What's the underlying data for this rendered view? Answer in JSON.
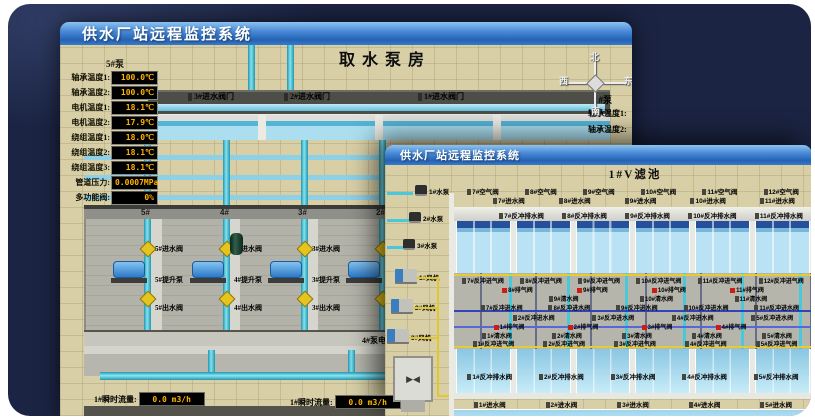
{
  "colors": {
    "shell_bg": "#1b2443",
    "titlebar_blue": "#2f6fc0",
    "ground_beige": "#d8cfa7",
    "readout_text": "#ffb400",
    "pipe_cyan": "#49c8dc",
    "valve_yellow": "#e6c41e",
    "alarm_red": "#cc1c14"
  },
  "back_window": {
    "titlebar": "供水厂站远程监控系统",
    "scene_title": "取水泵房",
    "pump_panel": {
      "header": "5#泵",
      "rows": [
        {
          "label": "轴承温度1:",
          "value": "100.0℃"
        },
        {
          "label": "轴承温度2:",
          "value": "100.0℃"
        },
        {
          "label": "电机温度1:",
          "value": "18.1℃"
        },
        {
          "label": "电机温度2:",
          "value": "17.9℃"
        },
        {
          "label": "绕组温度1:",
          "value": "18.0℃"
        },
        {
          "label": "绕组温度2:",
          "value": "18.1℃"
        },
        {
          "label": "绕组温度3:",
          "value": "18.1℃"
        },
        {
          "label": "管道压力:",
          "value": "0.0007MPa"
        },
        {
          "label": "多功能阀:",
          "value": "0%"
        }
      ]
    },
    "intake_valves": [
      "3#进水阀门",
      "2#进水阀门",
      "1#进水阀门"
    ],
    "compass": {
      "north": "北",
      "west": "西",
      "south": "南",
      "east": "东"
    },
    "right_panel": {
      "header": "1#泵",
      "rows": [
        "轴承温度1:",
        "轴承温度2:"
      ]
    },
    "pump_bays": [
      {
        "no": "5#",
        "inlet": "5#进水阀",
        "pump": "5#提升泵",
        "outlet": "5#出水阀"
      },
      {
        "no": "4#",
        "inlet": "4#进水阀",
        "pump": "4#提升泵",
        "outlet": "4#出水阀"
      },
      {
        "no": "3#",
        "inlet": "3#进水阀",
        "pump": "3#提升泵",
        "outlet": "3#出水阀"
      },
      {
        "no": "2#",
        "inlet": "2#进水阀",
        "pump": "2#提升泵",
        "outlet": "2#出水阀"
      }
    ],
    "current_readouts": [
      {
        "label": "4#泵电流:",
        "value": "00.0 A"
      },
      {
        "label": "2#泵电流:",
        "value": ""
      }
    ],
    "flow_readouts": [
      {
        "label": "1#瞬时流量:",
        "value": "0.0 m3/h"
      },
      {
        "label": "1#瞬时流量:",
        "value": "0.0 m3/h"
      }
    ]
  },
  "front_window": {
    "titlebar": "供水厂站远程监控系统",
    "scene_title": "1#V滤池",
    "equipment": [
      "1#水泵",
      "2#水泵",
      "3#水泵",
      "1#风机",
      "2#风机",
      "3#风机"
    ],
    "top_air_valves": [
      "7#空气阀",
      "8#空气阀",
      "9#空气阀",
      "10#空气阀",
      "11#空气阀",
      "12#空气阀"
    ],
    "top_inlet_valves": [
      "7#进水阀",
      "8#进水阀",
      "9#进水阀",
      "10#进水阀",
      "11#进水阀"
    ],
    "top_drain_valves": [
      "7#反冲排水阀",
      "8#反冲排水阀",
      "9#反冲排水阀",
      "10#反冲排水阀",
      "11#反冲排水阀"
    ],
    "gallery": {
      "backwash_air_top": [
        "7#反冲进气阀",
        "8#反冲进气阀",
        "9#反冲进气阀",
        "10#反冲进气阀",
        "11#反冲进气阀",
        "12#反冲进气阀"
      ],
      "exhaust_top": [
        "8#排气阀",
        "9#排气阀",
        "10#排气阀",
        "11#排气阀"
      ],
      "clean_top": [
        "9#清水阀",
        "10#清水阀",
        "11#清水阀"
      ],
      "backwash_water_top": [
        "7#反冲进水阀",
        "8#反冲进水阀",
        "9#反冲进水阀",
        "10#反冲进水阀",
        "11#反冲进水阀"
      ],
      "backwash_water_bottom": [
        "2#反冲进水阀",
        "3#反冲进水阀",
        "4#反冲进水阀",
        "5#反冲进水阀"
      ],
      "exhaust_bottom": [
        "1#排气阀",
        "2#排气阀",
        "3#排气阀",
        "4#排气阀"
      ],
      "clean_bottom": [
        "1#清水阀",
        "2#清水阀",
        "3#清水阀",
        "4#清水阀",
        "5#清水阀"
      ],
      "backwash_air_bottom": [
        "1#反冲进气阀",
        "2#反冲进气阀",
        "3#反冲进气阀",
        "4#反冲进气阀",
        "5#反冲进气阀"
      ]
    },
    "bottom_drain_valves": [
      "1#反冲排水阀",
      "2#反冲排水阀",
      "3#反冲排水阀",
      "4#反冲排水阀",
      "5#反冲排水阀"
    ],
    "bottom_inlet_valves": [
      "1#进水阀",
      "2#进水阀",
      "3#进水阀",
      "4#进水阀",
      "5#进水阀"
    ],
    "bottom_air_valves": [
      "1#空气阀",
      "2#空气阀",
      "3#空气阀",
      "4#空气阀",
      "5#空气阀"
    ]
  }
}
